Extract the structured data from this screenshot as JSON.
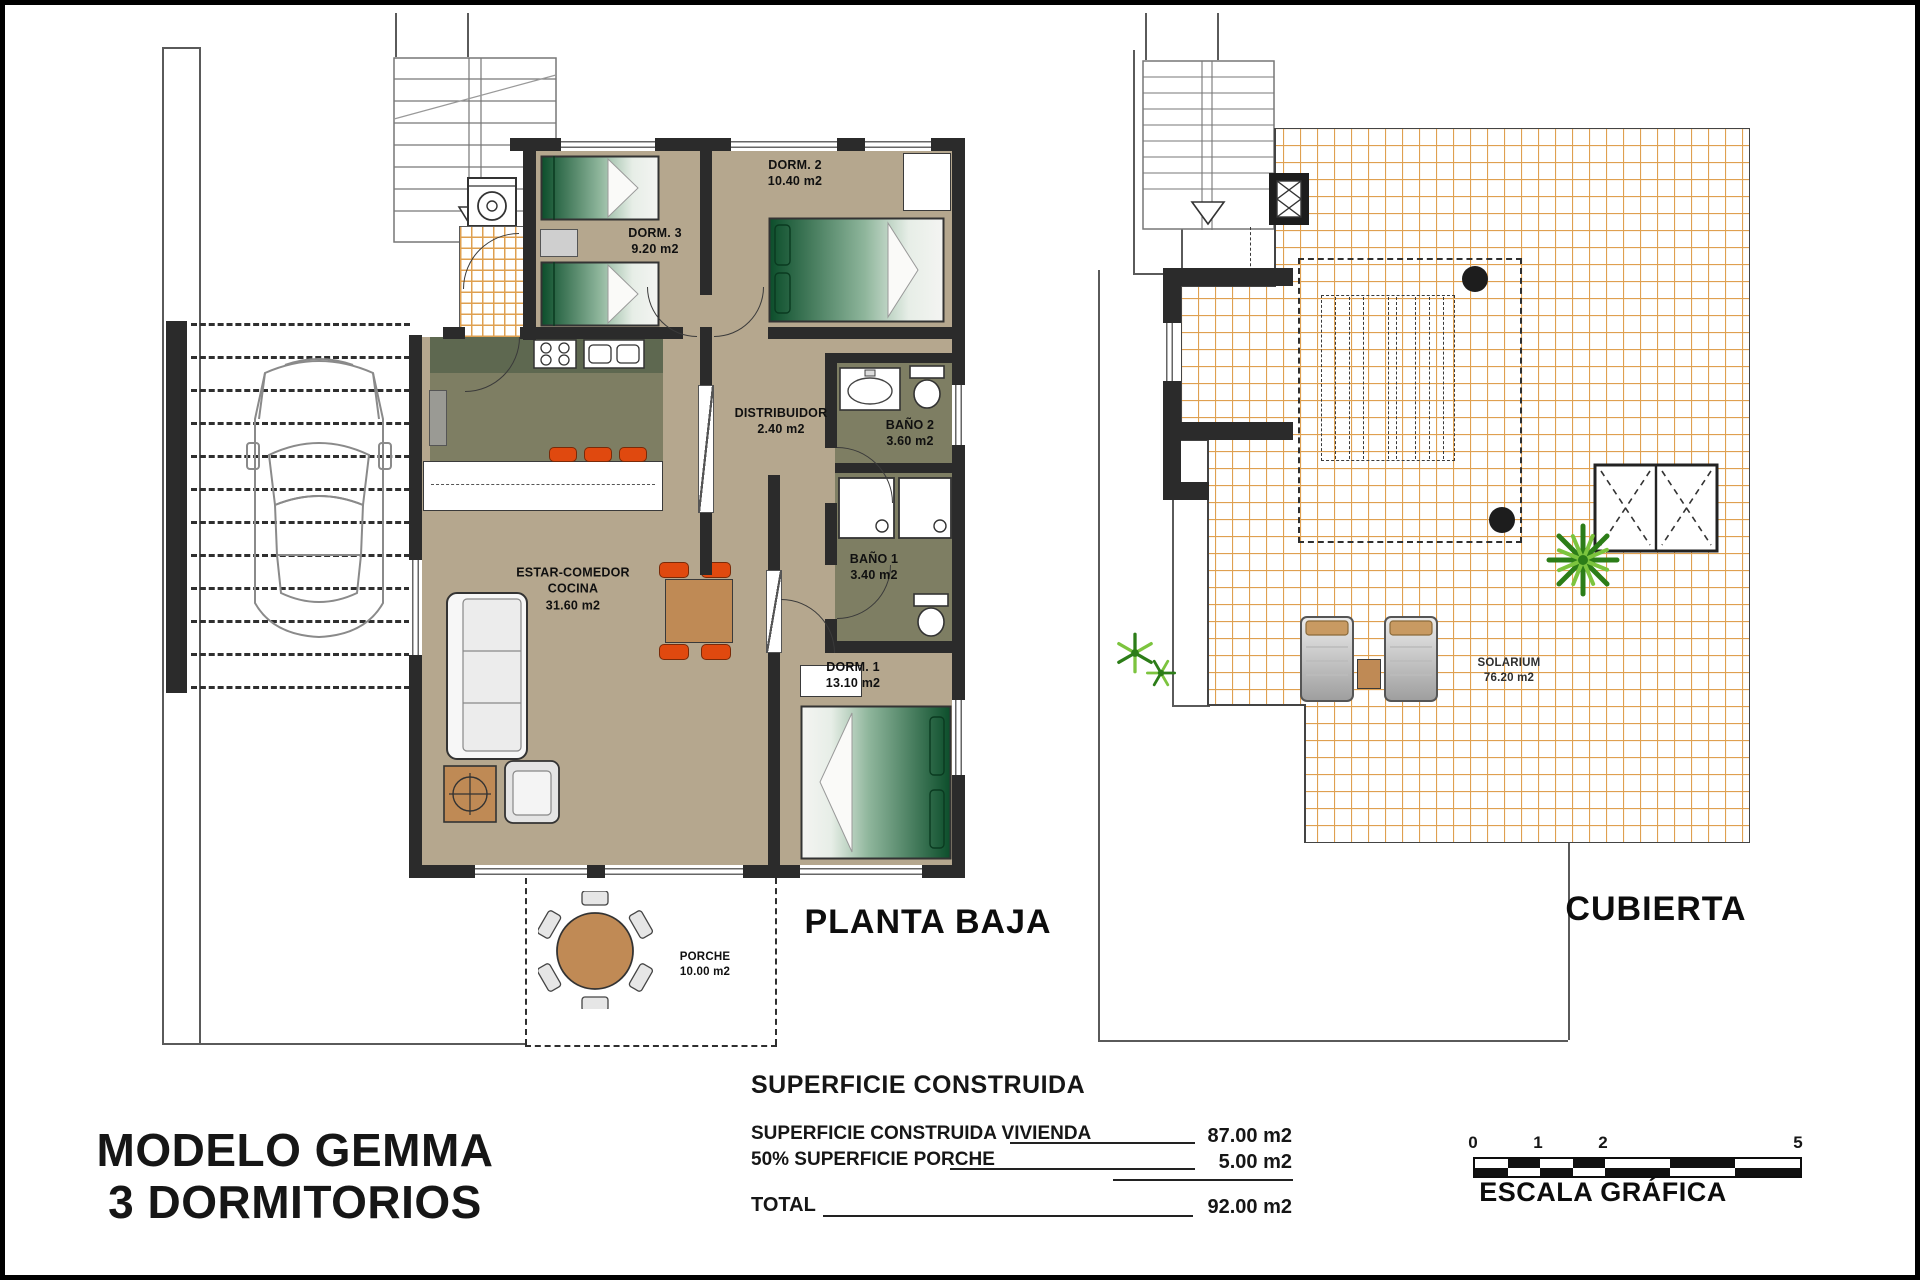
{
  "title": {
    "line1": "MODELO GEMMA",
    "line2": "3 DORMITORIOS"
  },
  "ground_plan": {
    "caption": "PLANTA BAJA",
    "rooms": {
      "dorm3": {
        "name": "DORM. 3",
        "area": "9.20 m2"
      },
      "dorm2": {
        "name": "DORM. 2",
        "area": "10.40 m2"
      },
      "distribuidor": {
        "name": "DISTRIBUIDOR",
        "area": "2.40 m2"
      },
      "bano2": {
        "name": "BAÑO 2",
        "area": "3.60 m2"
      },
      "bano1": {
        "name": "BAÑO 1",
        "area": "3.40 m2"
      },
      "dorm1": {
        "name": "DORM. 1",
        "area": "13.10 m2"
      },
      "estar": {
        "name": "ESTAR-COMEDOR",
        "name2": "COCINA",
        "area": "31.60 m2"
      },
      "porche": {
        "name": "PORCHE",
        "area": "10.00 m2"
      }
    }
  },
  "roof_plan": {
    "caption": "CUBIERTA",
    "rooms": {
      "solarium": {
        "name": "SOLARIUM",
        "area": "76.20 m2"
      }
    }
  },
  "areas_table": {
    "title": "SUPERFICIE CONSTRUIDA",
    "rows": [
      {
        "label": "SUPERFICIE CONSTRUIDA VIVIENDA",
        "value": "87.00 m2"
      },
      {
        "label": "50% SUPERFICIE PORCHE",
        "value": "5.00 m2"
      },
      {
        "label": "TOTAL",
        "value": "92.00 m2"
      }
    ]
  },
  "scale_bar": {
    "caption": "ESCALA GRÁFICA",
    "ticks": [
      "0",
      "1",
      "2",
      "5"
    ]
  },
  "colors": {
    "wall": "#2b2b2b",
    "floor_tan": "#b5a78e",
    "wet_room_olive": "#7e7e63",
    "tile_line": "#dfa050",
    "accent_orange": "#e0490f",
    "wood": "#bf8a55",
    "bed_green": "#0c4e2b",
    "plant_green": "#2c7d18"
  }
}
